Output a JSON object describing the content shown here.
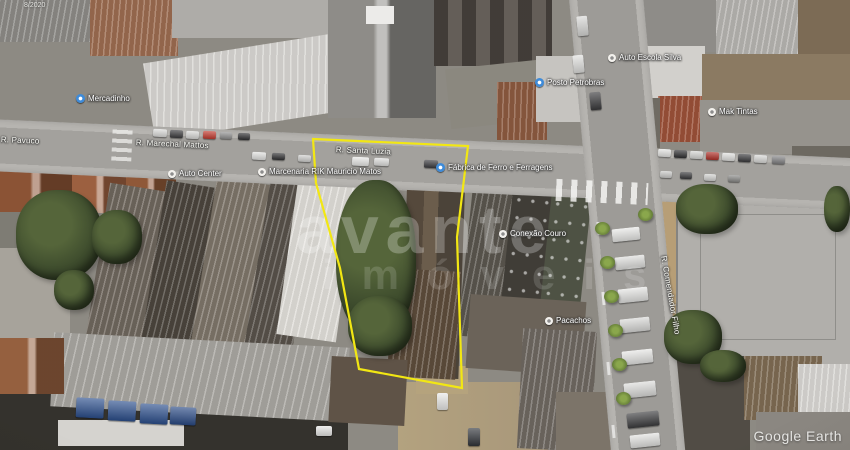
{
  "map": {
    "credit": "Google Earth",
    "date_label": "8/2020",
    "watermark": {
      "line1": "avante",
      "line2": "imóveis"
    }
  },
  "parcel": {
    "outline_color": "#f2e713",
    "points": [
      [
        313,
        139
      ],
      [
        468,
        146
      ],
      [
        457,
        237
      ],
      [
        462,
        388
      ],
      [
        359,
        369
      ],
      [
        340,
        268
      ],
      [
        316,
        183
      ]
    ]
  },
  "labels": {
    "streets": [
      {
        "text": "R. Pavuco",
        "x": 1,
        "y": 135,
        "rot": 2.5
      },
      {
        "text": "R. Marechal Mattos",
        "x": 136,
        "y": 138,
        "rot": 2.5
      },
      {
        "text": "R. Santa Luzia",
        "x": 336,
        "y": 145,
        "rot": 2.5
      },
      {
        "text": "R. Comendador Filho",
        "x": 668,
        "y": 255,
        "rot": 80
      }
    ],
    "places": [
      {
        "text": "Mercadinho",
        "icon": "blue",
        "x": 76,
        "y": 94
      },
      {
        "text": "Auto Center",
        "icon": "white",
        "x": 168,
        "y": 169
      },
      {
        "text": "Marcenaria RIK Mauricio Matos",
        "icon": "white",
        "x": 258,
        "y": 167
      },
      {
        "text": "Fábrica de Ferro e Ferragens",
        "icon": "blue",
        "x": 436,
        "y": 163
      },
      {
        "text": "Posto Petrobras",
        "icon": "blue",
        "x": 535,
        "y": 78
      },
      {
        "text": "Auto Escola Silva",
        "icon": "white",
        "x": 608,
        "y": 53
      },
      {
        "text": "Mak Tintas",
        "icon": "white",
        "x": 708,
        "y": 107
      },
      {
        "text": "Conexão Couro",
        "icon": "white",
        "x": 499,
        "y": 229
      },
      {
        "text": "Pacachos",
        "icon": "white",
        "x": 545,
        "y": 316
      }
    ],
    "icon_colors": {
      "blue": "#3e8bd9",
      "white": "#f3f1ed"
    }
  }
}
